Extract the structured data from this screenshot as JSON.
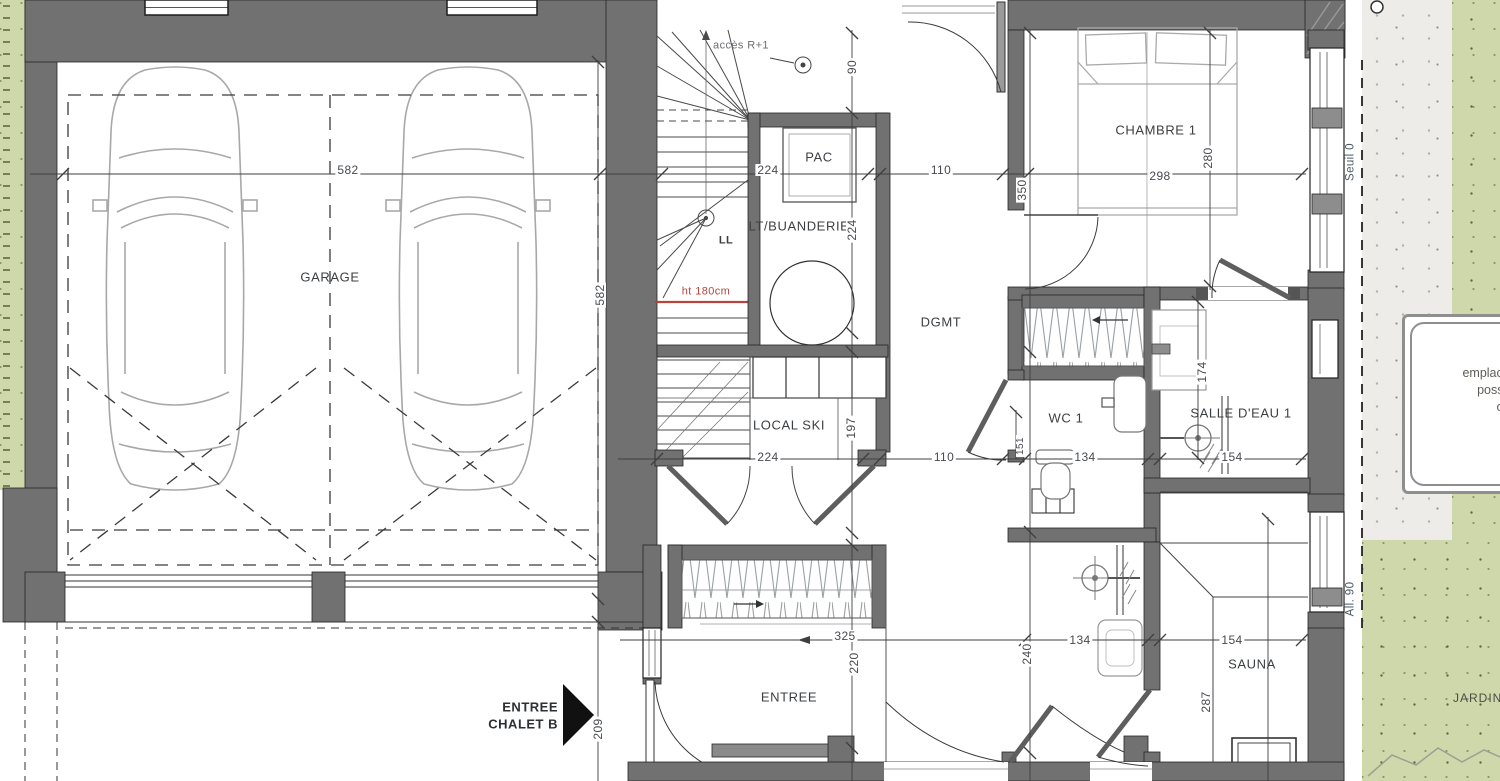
{
  "plan": {
    "rooms": {
      "garage": "GARAGE",
      "chambre1": "CHAMBRE 1",
      "dgmt": "DGMT",
      "wc1": "WC 1",
      "sde1": "SALLE D'EAU 1",
      "sauna": "SAUNA",
      "local_ski": "LOCAL SKI",
      "buanderie": "LT/BUANDERIE",
      "pac": "PAC",
      "entree": "ENTREE",
      "washer": "LL"
    },
    "annotations": {
      "acces": "accès R+1",
      "height_note": "ht 180cm",
      "chalet_entry_line1": "ENTREE",
      "chalet_entry_line2": "CHALET B",
      "seuil": "Seuil 0",
      "allege": "All. 90",
      "jardin": "JARDIN",
      "emplacement_line1": "emplacement",
      "emplacement_line2": "possible",
      "emplacement_line3": "o"
    },
    "dimensions": {
      "garage_width": "582",
      "garage_depth": "582",
      "stair_access_width": "90",
      "buanderie_width": "224",
      "buanderie_depth": "224",
      "hall_width_top": "110",
      "chambre1_width": "298",
      "chambre1_depth": "280",
      "dgmt_length": "350",
      "local_ski_width": "224",
      "local_ski_depth": "197",
      "hall_width_bottom": "110",
      "wc1_recess": "151",
      "wc1_width": "134",
      "sde1_width": "154",
      "sde1_depth": "174",
      "placard_width": "325",
      "entree_depth": "220",
      "entrance_offset": "209",
      "sde2_width": "134",
      "sde2_depth": "240",
      "sauna_width": "154",
      "sauna_depth": "287"
    },
    "colors": {
      "wall": "#717171",
      "garden_green": "#cfd8ab",
      "gravel": "#edece8",
      "red_note": "#b5453c",
      "text": "#3f4246"
    }
  }
}
